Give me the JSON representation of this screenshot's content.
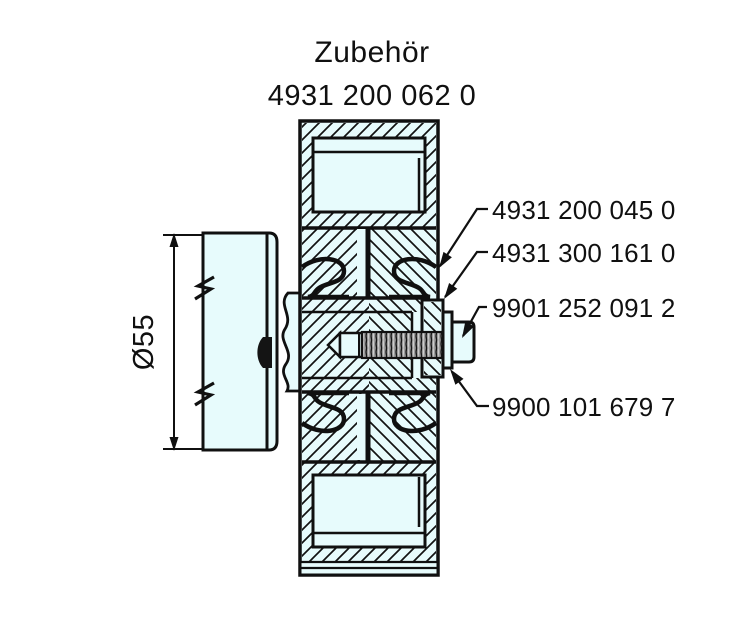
{
  "title": "Zubehör",
  "assembly_number": "4931 200 062 0",
  "dimension": {
    "label": "Ø55"
  },
  "parts": [
    {
      "number": "4931 200 045 0",
      "target": "clutch-housing"
    },
    {
      "number": "4931 300 161 0",
      "target": "flange-plate"
    },
    {
      "number": "9901 252 091 2",
      "target": "bolt-head"
    },
    {
      "number": "9900 101 679 7",
      "target": "washer"
    }
  ],
  "colors": {
    "background": "#ffffff",
    "part_fill": "#e7fbfc",
    "line": "#101010",
    "thread_fill": "#9b9b9b"
  }
}
